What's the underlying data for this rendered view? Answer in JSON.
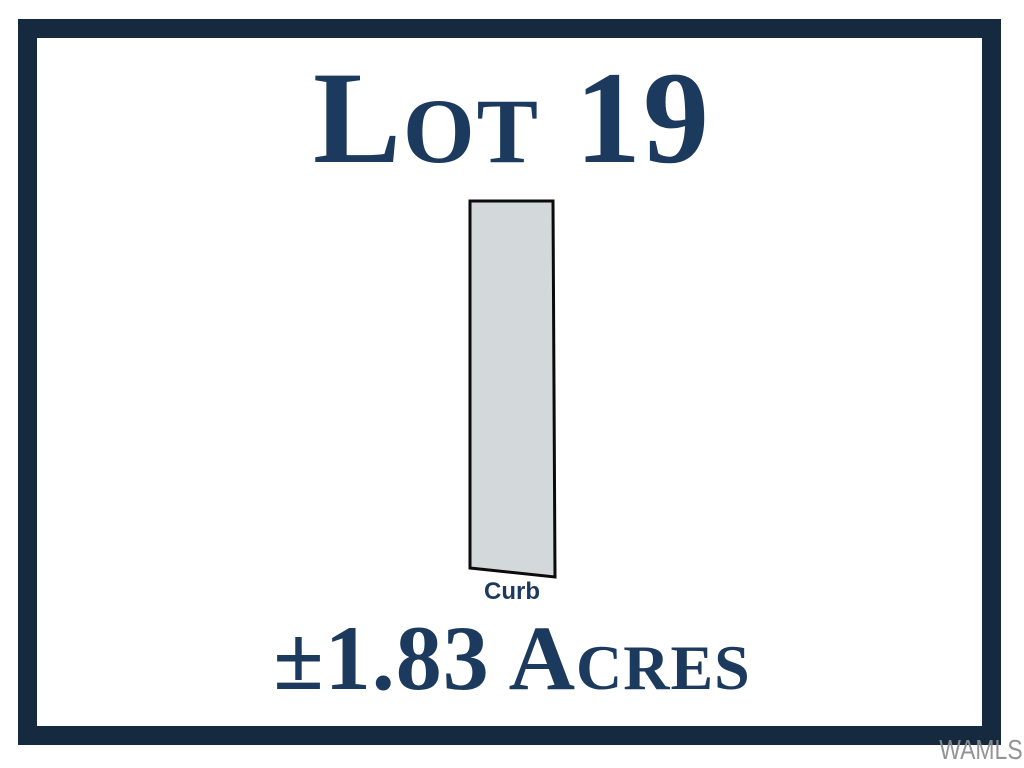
{
  "colors": {
    "background": "#ffffff",
    "frame_navy": "#152A3E",
    "text_navy": "#1C3A5E",
    "parcel_fill": "#D3D8DA",
    "parcel_stroke": "#0B0B0B",
    "watermark_gray": "#8F8F8F"
  },
  "graphic": {
    "title": "Lot 19",
    "acreage": "±1.83 Acres",
    "watermark": "WAMLS"
  },
  "parcel": {
    "label": "Curb",
    "points": "470,201 553,201 555,577 470,568"
  }
}
